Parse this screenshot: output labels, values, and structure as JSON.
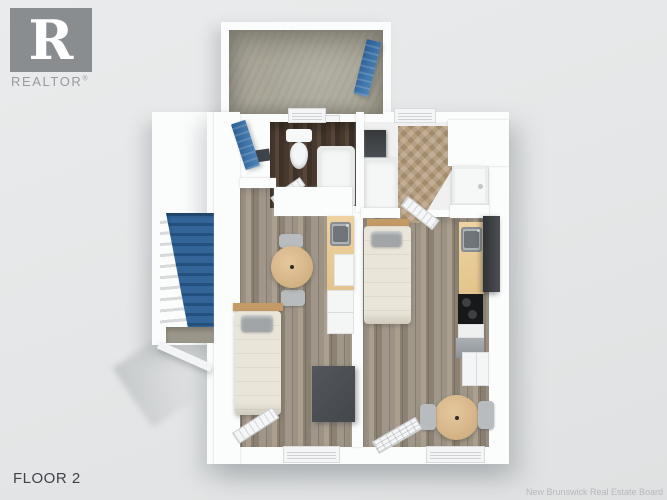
{
  "branding": {
    "logo_letter": "R",
    "logo_text": "REALTOR",
    "registered_mark": "®",
    "logo_color": "#8a8d90"
  },
  "labels": {
    "floor": "FLOOR 2",
    "watermark": "New Brunswick Real Estate Board"
  },
  "floorplan": {
    "view": "3D top-down render",
    "floor_name": "Floor 2",
    "rooms": [
      {
        "name": "storage room",
        "floor": "concrete",
        "features": [
          "blue open door"
        ]
      },
      {
        "name": "stairwell",
        "features": [
          "blue staircase",
          "white railing",
          "concrete landing",
          "blue entry door"
        ]
      },
      {
        "name": "bathroom A",
        "floor": "dark wood",
        "fixtures": [
          "toilet",
          "bathtub",
          "window"
        ]
      },
      {
        "name": "bathroom B",
        "floor": "herringbone wood",
        "fixtures": [
          "washer",
          "bathtub",
          "vanity sink",
          "window"
        ]
      },
      {
        "name": "studio A",
        "floor": "grey-brown plank wood",
        "furniture": [
          "round dining table",
          "two chairs",
          "kitchenette counter with sink",
          "dishwasher",
          "single bed",
          "dark dresser",
          "glazed door",
          "window"
        ]
      },
      {
        "name": "studio B",
        "floor": "grey-brown plank wood",
        "furniture": [
          "single bed",
          "kitchen counter with sink",
          "fridge",
          "stove",
          "dishwasher",
          "corner cabinet",
          "round dining table",
          "two chairs",
          "glazed door",
          "window"
        ]
      }
    ],
    "colors": {
      "background": "#e4e6e7",
      "walls": "#fbfcfc",
      "stairs_blue": "#2f5f91",
      "door_blue": "#3a6da3",
      "wood_floor": "#978d80",
      "dark_bath_floor": "#4a3c31",
      "herringbone_floor": "#ab9478",
      "concrete_floor": "#aaa79a",
      "table_wood": "#d2b184",
      "bedding": "#e9e5d9",
      "appliance_dark": "#44484c"
    }
  }
}
